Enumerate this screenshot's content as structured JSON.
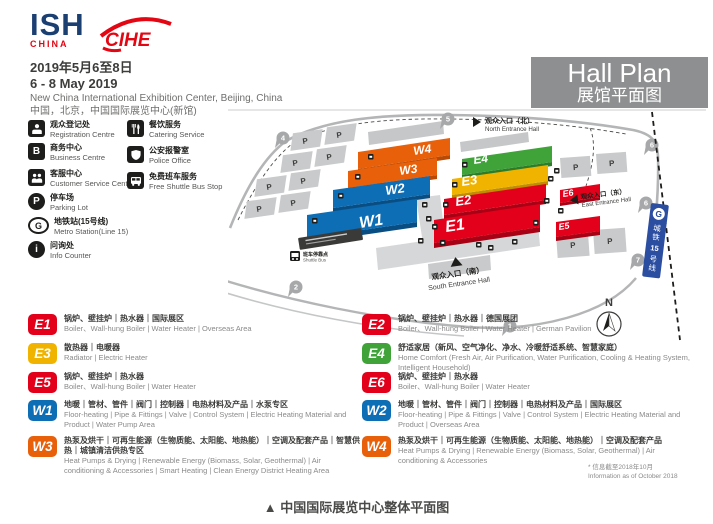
{
  "header": {
    "logo_ish": {
      "text": "ISH",
      "sub": "CHINA"
    },
    "logo_cihe": {
      "text": "CIHE"
    },
    "date_cn": "2019年5月6至8日",
    "date_en": "6 - 8 May 2019",
    "venue_en": "New China International Exhibition Center, Beijing, China",
    "venue_cn": "中国，北京，中国国际展览中心(新馆)"
  },
  "hall_plan": {
    "title_en": "Hall Plan",
    "title_cn": "展馆平面图"
  },
  "facilities": {
    "col1": [
      {
        "cn": "观众登记处",
        "en": "Registration Centre",
        "glyph": ""
      },
      {
        "cn": "商务中心",
        "en": "Business Centre",
        "glyph": "B"
      },
      {
        "cn": "客服中心",
        "en": "Customer Service Centre",
        "glyph": ""
      },
      {
        "cn": "停车场",
        "en": "Parking Lot",
        "glyph": "P"
      },
      {
        "cn": "地铁站(15号线)",
        "en": "Metro Station(Line 15)",
        "glyph": "G"
      },
      {
        "cn": "问询处",
        "en": "Info Counter",
        "glyph": "i"
      }
    ],
    "col2": [
      {
        "cn": "餐饮服务",
        "en": "Catering Service",
        "glyph": ""
      },
      {
        "cn": "公安报警室",
        "en": "Police Office",
        "glyph": ""
      },
      {
        "cn": "免费班车服务",
        "en": "Free Shuttle Bus Stop",
        "glyph": ""
      }
    ]
  },
  "map": {
    "halls": [
      {
        "id": "W1",
        "label": "W1",
        "color": "#0d6db5",
        "side": "#094e83"
      },
      {
        "id": "W2",
        "label": "W2",
        "color": "#0d6db5",
        "side": "#094e83"
      },
      {
        "id": "W3",
        "label": "W3",
        "color": "#e8600a",
        "side": "#b84a05"
      },
      {
        "id": "W4",
        "label": "W4",
        "color": "#e8600a",
        "side": "#b84a05"
      },
      {
        "id": "E1",
        "label": "E1",
        "color": "#e2001a",
        "side": "#a80014"
      },
      {
        "id": "E2",
        "label": "E2",
        "color": "#e2001a",
        "side": "#a80014"
      },
      {
        "id": "E3",
        "label": "E3",
        "color": "#f0b400",
        "side": "#c08d00"
      },
      {
        "id": "E4",
        "label": "E4",
        "color": "#3fa33a",
        "side": "#2d7c2a"
      },
      {
        "id": "E5",
        "label": "E5",
        "color": "#e2001a",
        "side": "#a80014"
      },
      {
        "id": "E6",
        "label": "E6",
        "color": "#e2001a",
        "side": "#a80014"
      }
    ],
    "entrances": {
      "north_cn": "观众入口（北）",
      "north_en": "North Entrance Hall",
      "east_cn": "观众入口（东）",
      "east_en": "East Entrance Hall",
      "south_cn": "观众入口（南）",
      "south_en": "South Entrance Hall"
    },
    "gates": [
      "4",
      "5",
      "6",
      "6",
      "7",
      "2",
      "1"
    ],
    "parking_label": "P",
    "metro_line_label": "城铁15号线",
    "metro_line_chars": [
      "城",
      "铁",
      "15",
      "号",
      "线"
    ],
    "metro_logo": "G",
    "compass": "N",
    "shuttle_stop": {
      "cn": "班车停靠点",
      "en": "Shuttle Bus"
    }
  },
  "legend": {
    "items": [
      {
        "code": "E1",
        "color": "#e2001a",
        "cn": "锅炉、壁挂炉｜热水器｜国际展区",
        "en": "Boiler、Wall-hung Boiler | Water Heater | Overseas Area"
      },
      {
        "code": "E2",
        "color": "#e2001a",
        "cn": "锅炉、壁挂炉｜热水器｜德国展团",
        "en": "Boiler、Wall-hung Boiler | Water Heater | German Pavilion"
      },
      {
        "code": "E3",
        "color": "#f0b400",
        "cn": "散热器｜电暖器",
        "en": "Radiator | Electric Heater"
      },
      {
        "code": "E4",
        "color": "#3fa33a",
        "cn": "舒适家居（新风、空气净化、净水、冷暖舒适系统、智慧家庭）",
        "en": "Home Comfort (Fresh Air, Air Purification, Water Purification, Cooling & Heating System, Intelligent Household)"
      },
      {
        "code": "E5",
        "color": "#e2001a",
        "cn": "锅炉、壁挂炉｜热水器",
        "en": "Boiler、Wall-hung Boiler | Water Heater"
      },
      {
        "code": "E6",
        "color": "#e2001a",
        "cn": "锅炉、壁挂炉｜热水器",
        "en": "Boiler、Wall-hung Boiler | Water Heater"
      },
      {
        "code": "W1",
        "color": "#0d6db5",
        "cn": "地暖｜管材、管件｜阀门｜控制器｜电热材料及产品｜水泵专区",
        "en": "Floor-heating | Pipe & Fittings | Valve | Control System | Electric Heating Material and Product | Water Pump Area"
      },
      {
        "code": "W2",
        "color": "#0d6db5",
        "cn": "地暖｜管材、管件｜阀门｜控制器｜电热材料及产品｜国际展区",
        "en": "Floor-heating | Pipe & Fittings | Valve | Control System | Electric Heating Material and Product | Overseas Area"
      },
      {
        "code": "W3",
        "color": "#e8600a",
        "cn": "热泵及烘干｜可再生能源（生物质能、太阳能、地热能）｜空调及配套产品｜智慧供热｜城镇清洁供热专区",
        "en": "Heat Pumps & Drying | Renewable Energy (Biomass, Solar, Geothermal) | Air conditioning & Accessories | Smart Heating | Clean Energy District Heating Area"
      },
      {
        "code": "W4",
        "color": "#e8600a",
        "cn": "热泵及烘干｜可再生能源（生物质能、太阳能、地热能）｜空调及配套产品",
        "en": "Heat Pumps & Drying | Renewable Energy (Biomass, Solar, Geothermal) | Air conditioning & Accessories"
      }
    ]
  },
  "note": {
    "cn": "* 信息截至2018年10月",
    "en": "Information as of October 2018"
  },
  "caption": {
    "marker": "▲",
    "text": "中国国际展览中心整体平面图"
  }
}
